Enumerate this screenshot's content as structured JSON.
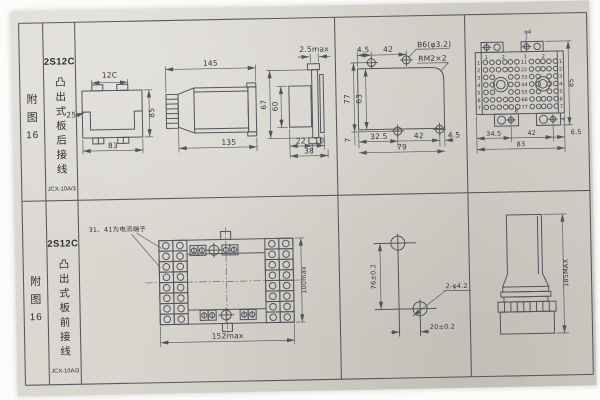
{
  "table": {
    "row1": {
      "figure_chars": [
        "附",
        "图",
        "16"
      ],
      "model": "2S12C",
      "description": "凸出式板后接线",
      "code": "JCX-10A/3"
    },
    "row2": {
      "figure_chars": [
        "附",
        "图",
        "16"
      ],
      "model": "2S12C",
      "description": "凸出式板前接线",
      "code": "JCX-10A/3"
    }
  },
  "drawings": {
    "case_front": {
      "dim_top": "12C",
      "dim_left": "25",
      "dim_height": "85",
      "dim_width": "83"
    },
    "case_side": {
      "dim_top": "145",
      "dim_bottom": "135"
    },
    "case_rear": {
      "dim_top": "2.5max",
      "dim_outer_height": "67",
      "dim_inner_height": "60",
      "dim_b1": "22",
      "dim_b2": "10",
      "dim_total": "38"
    },
    "panel_cutout": {
      "dim_t1": "4.5",
      "dim_t2": "42",
      "hole_note": "B6(φ3.2)",
      "thread_note": "RM2×2",
      "dim_left": "77",
      "dim_inner": "63",
      "dim_corner": "7",
      "dim_b1": "32.5",
      "dim_b2": "42",
      "dim_b3": "4.5",
      "dim_total": "79"
    },
    "terminal_board": {
      "hole_note": "φ4",
      "top_labels": [
        "1",
        "2",
        "1",
        "2"
      ],
      "row_numbers": [
        "1",
        "2",
        "3",
        "4",
        "5",
        "6",
        "7"
      ],
      "pair_labels": [
        "11",
        "22",
        "33",
        "44",
        "55",
        "66",
        "77"
      ],
      "dim_offset": "8",
      "dim_edge": "4",
      "dim_height": "85",
      "dim_b1": "34.5",
      "dim_b2": "42",
      "dim_b3": "6.5",
      "dim_total": "83"
    },
    "front_panel": {
      "note": "31、41为电流端子",
      "dim_width": "152max",
      "dim_height": "100max"
    },
    "drill_plan": {
      "dim_v": "76±0.2",
      "dim_h": "20±0.2",
      "hole_note": "2-φ4.2"
    },
    "side_profile": {
      "dim_height": "185MAX"
    }
  }
}
